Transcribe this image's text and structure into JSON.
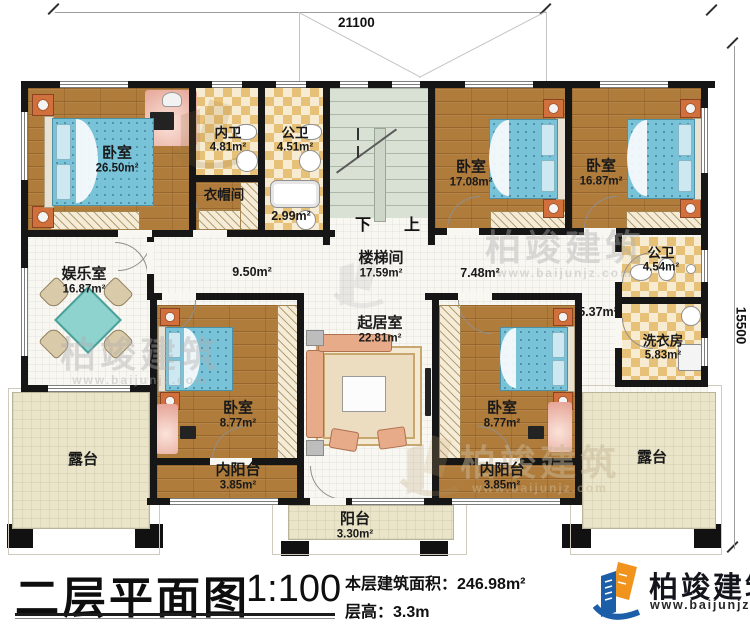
{
  "titleblock": {
    "title": "二层平面图",
    "scale": "1:100",
    "area_label": "本层建筑面积：",
    "area_value": "246.98m²",
    "height_label": "层高：",
    "height_value": "3.3m"
  },
  "brand": {
    "name": "柏竣建筑",
    "url": "www.baijunjz.com",
    "blue": "#1c5fa8",
    "orange": "#f0941d"
  },
  "watermark": {
    "text": "柏竣建筑",
    "url": "www.baijunjz.com"
  },
  "dimensions": {
    "top": "21100",
    "right": "15500"
  },
  "stairs": {
    "down": "下",
    "up": "上"
  },
  "rooms": {
    "bedroom_master": {
      "name": "卧室",
      "area": "26.50m²"
    },
    "bath_inner": {
      "name": "内卫",
      "area": "4.81m²"
    },
    "bath_public_top": {
      "name": "公卫",
      "area": "4.51m²"
    },
    "cloakroom": {
      "name": "衣帽间",
      "area": "2.99m²"
    },
    "bedroom_2": {
      "name": "卧室",
      "area": "17.08m²"
    },
    "bedroom_3": {
      "name": "卧室",
      "area": "16.87m²"
    },
    "bath_public_right": {
      "name": "公卫",
      "area": "4.54m²"
    },
    "laundry": {
      "name": "洗衣房",
      "area": "5.83m²"
    },
    "entertainment": {
      "name": "娱乐室",
      "area": "16.87m²"
    },
    "stairwell": {
      "name": "楼梯间",
      "area": "17.59m²"
    },
    "living": {
      "name": "起居室",
      "area": "22.81m²"
    },
    "bedroom_4": {
      "name": "卧室",
      "area": "8.77m²"
    },
    "inner_balcony_left": {
      "name": "内阳台",
      "area": "3.85m²"
    },
    "bedroom_5": {
      "name": "卧室",
      "area": "8.77m²"
    },
    "inner_balcony_right": {
      "name": "内阳台",
      "area": "3.85m²"
    },
    "terrace_left": {
      "name": "露台",
      "area": ""
    },
    "terrace_right": {
      "name": "露台",
      "area": ""
    },
    "balcony": {
      "name": "阳台",
      "area": "3.30m²"
    },
    "hall_left": {
      "area": "9.50m²"
    },
    "hall_mid": {
      "area": "7.48m²"
    },
    "hall_right": {
      "area": "5.37m²"
    }
  }
}
